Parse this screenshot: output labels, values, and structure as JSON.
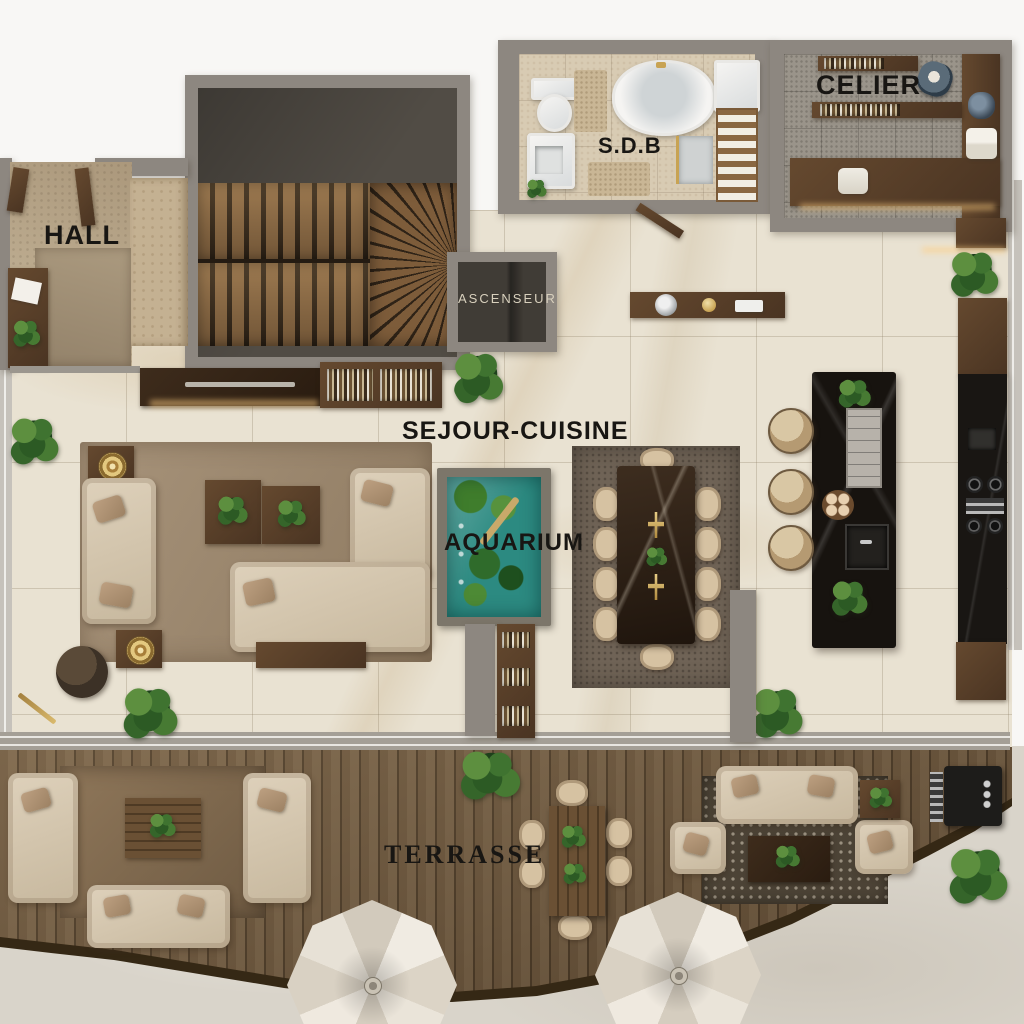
{
  "plan": {
    "rooms": {
      "hall": {
        "label": "HALL"
      },
      "elevator": {
        "label": "ASCENSEUR"
      },
      "bathroom": {
        "label": "S.D.B"
      },
      "pantry": {
        "label": "CELIER"
      },
      "living_kitchen": {
        "label": "SEJOUR-CUISINE"
      },
      "aquarium": {
        "label": "AQUARIUM"
      },
      "terrace": {
        "label": "TERRASSE"
      }
    },
    "colors": {
      "marble_floor": "#e9e2d2",
      "deck_wood": "#5f4a33",
      "wall_gray": "#8d8780",
      "aquarium_water": "#2c8a81",
      "sofa_beige": "#d7c9b1",
      "island_black": "#17130f",
      "label_text": "#181613",
      "elevator_label_text": "#d8d0bd",
      "gold_accent": "#c8a353"
    }
  }
}
